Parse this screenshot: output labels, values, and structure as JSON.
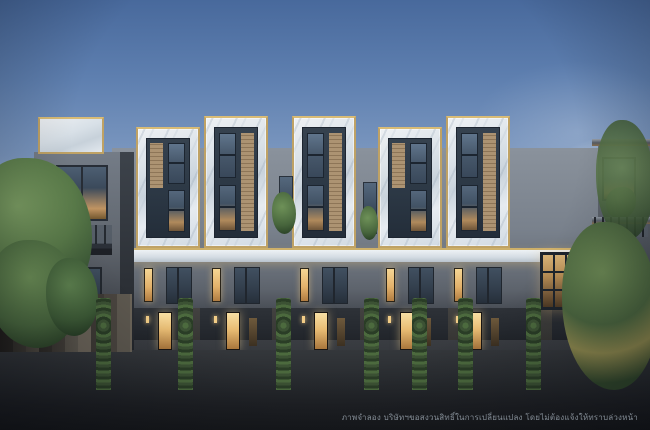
{
  "disclaimer": "ภาพจำลอง บริษัทฯขอสงวนสิทธิ์ในการเปลี่ยนแปลง โดยไม่ต้องแจ้งให้ทราบล่วงหน้า",
  "palette": {
    "sky_top": "#48699c",
    "sky_mid": "#7b97bf",
    "sky_horizon": "#cfdae6",
    "marble_panel": "#e3e8ed",
    "gold": "#bfa265",
    "wood": "#ac9372",
    "wall_gray": "#79818c",
    "wall_dark": "#262a30",
    "window_glass": "#46586c",
    "window_light": "#f4cd87",
    "road": "#222428",
    "hedge": "#3c5234",
    "tree_green": "#5f7d52"
  },
  "scene": {
    "description": "Dusk rendering of a row of modern 3-4 storey townhomes with white marble and gold-trim facades, warm lit windows, parked cars and trees",
    "towers": [
      {
        "variant": "short",
        "x": 136,
        "top": 127
      },
      {
        "variant": "tall",
        "x": 204,
        "top": 116
      },
      {
        "variant": "tall",
        "x": 292,
        "top": 116
      },
      {
        "variant": "short",
        "x": 378,
        "top": 127
      },
      {
        "variant": "tall",
        "x": 446,
        "top": 116
      }
    ],
    "hedges": [
      96,
      178,
      276,
      364,
      412,
      458,
      526
    ],
    "cars": [
      {
        "kind": "sports",
        "color": "#c9cdd1",
        "x": 16,
        "w": 56
      },
      {
        "kind": "sports",
        "color": "#dfe2e5",
        "x": 58,
        "w": 58
      },
      {
        "kind": "sedan",
        "color": "#24272c",
        "x": 124,
        "w": 60
      },
      {
        "kind": "sedan",
        "color": "#34383e",
        "x": 188,
        "w": 42
      },
      {
        "kind": "sedan",
        "color": "#e9ebed",
        "x": 226,
        "w": 50
      },
      {
        "kind": "sedan",
        "color": "#d9dcde",
        "x": 294,
        "w": 44
      },
      {
        "kind": "sedan",
        "color": "#222529",
        "x": 338,
        "w": 40
      },
      {
        "kind": "sports",
        "color": "#e6e8ea",
        "x": 380,
        "w": 48
      },
      {
        "kind": "sedan",
        "color": "#2e3237",
        "x": 428,
        "w": 44
      },
      {
        "kind": "sedan",
        "color": "#3f434a",
        "x": 472,
        "w": 48
      },
      {
        "kind": "sports",
        "color": "#e2e4e7",
        "x": 548,
        "w": 50
      },
      {
        "kind": "sedan",
        "color": "#686d74",
        "x": 592,
        "w": 48
      }
    ],
    "gap_windows": [
      {
        "x": 279,
        "y": 176
      },
      {
        "x": 363,
        "y": 182
      }
    ],
    "gap_plants": [
      {
        "x": 272,
        "y": 192,
        "w": 24,
        "h": 42
      },
      {
        "x": 360,
        "y": 206,
        "w": 18,
        "h": 34
      }
    ]
  }
}
